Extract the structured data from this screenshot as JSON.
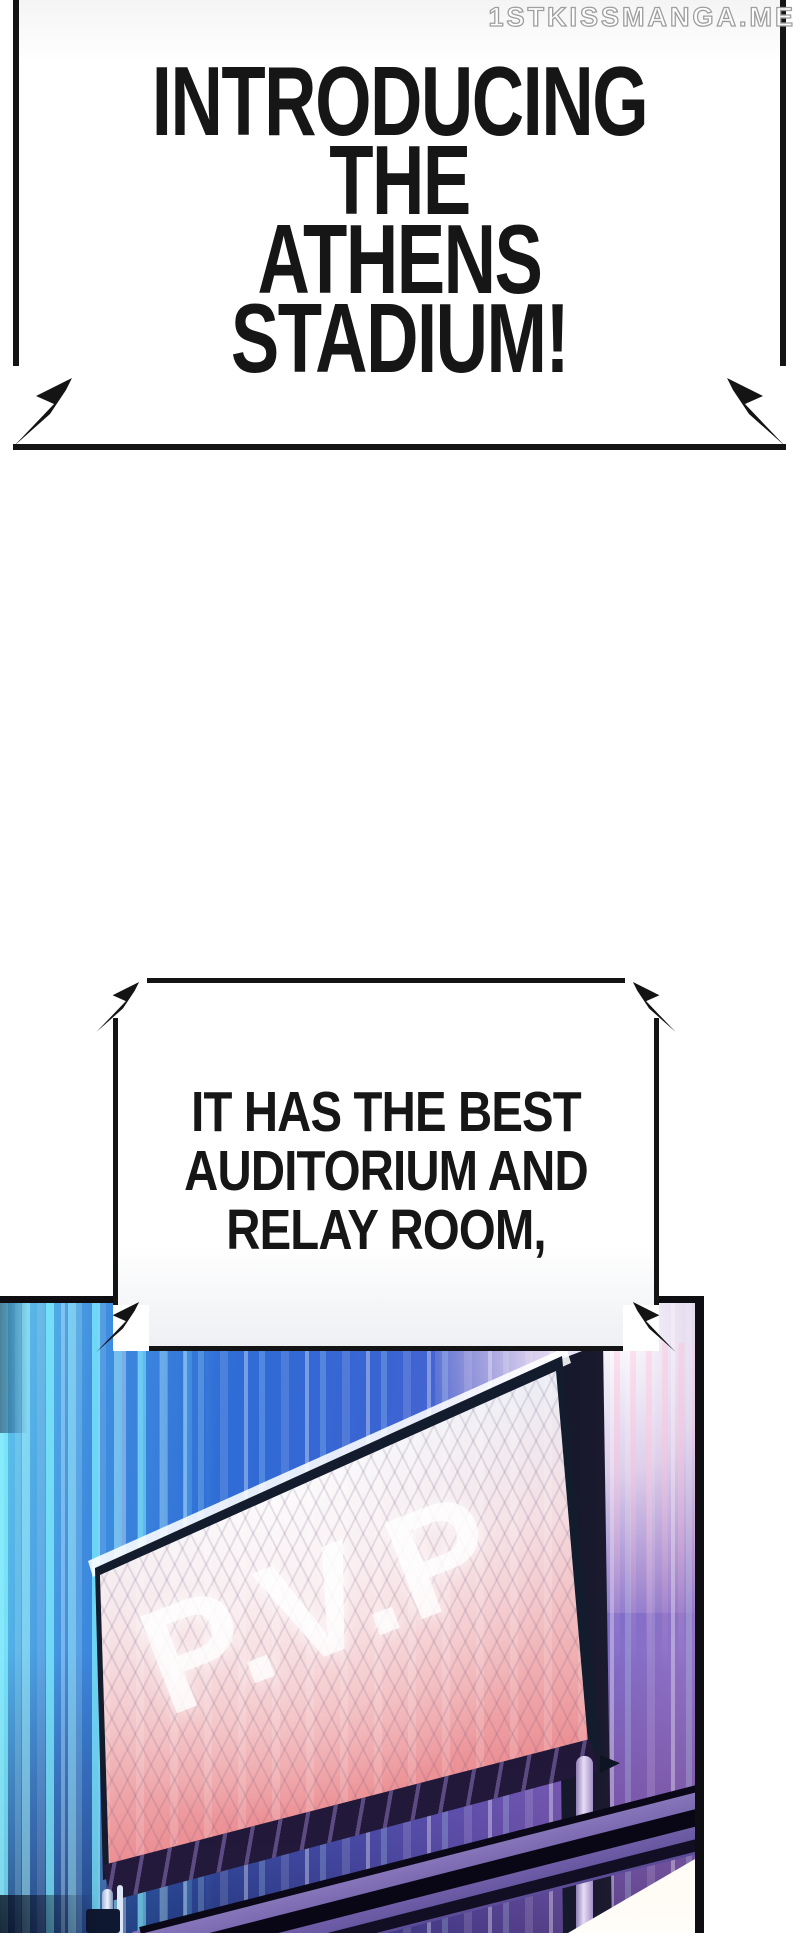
{
  "watermark": {
    "text": "1STKISSMANGA.ME"
  },
  "bubbles": [
    {
      "lines": [
        "INTRODUCING THE",
        "ATHENS STADIUM!"
      ]
    },
    {
      "lines": [
        "IT HAS THE BEST",
        "AUDITORIUM AND",
        "RELAY ROOM,"
      ]
    }
  ],
  "panel": {
    "screen_text": "P.V.P"
  },
  "colors": {
    "ink": "#141414",
    "paper": "#ffffff",
    "bubble_fill": "#ffffff",
    "panel_blue": "#2f6cd6",
    "panel_cyan": "#66cdea",
    "panel_purple": "#8f7cc4",
    "pole_dark": "#1c2a3e",
    "screen_light": "#cfe4f6",
    "screen_pink": "#f1b9bc",
    "screen_red": "#d95f66",
    "truss_black": "#0b0918",
    "lavender": "#e6ddf5",
    "glow_warm": "#fffdf8"
  }
}
